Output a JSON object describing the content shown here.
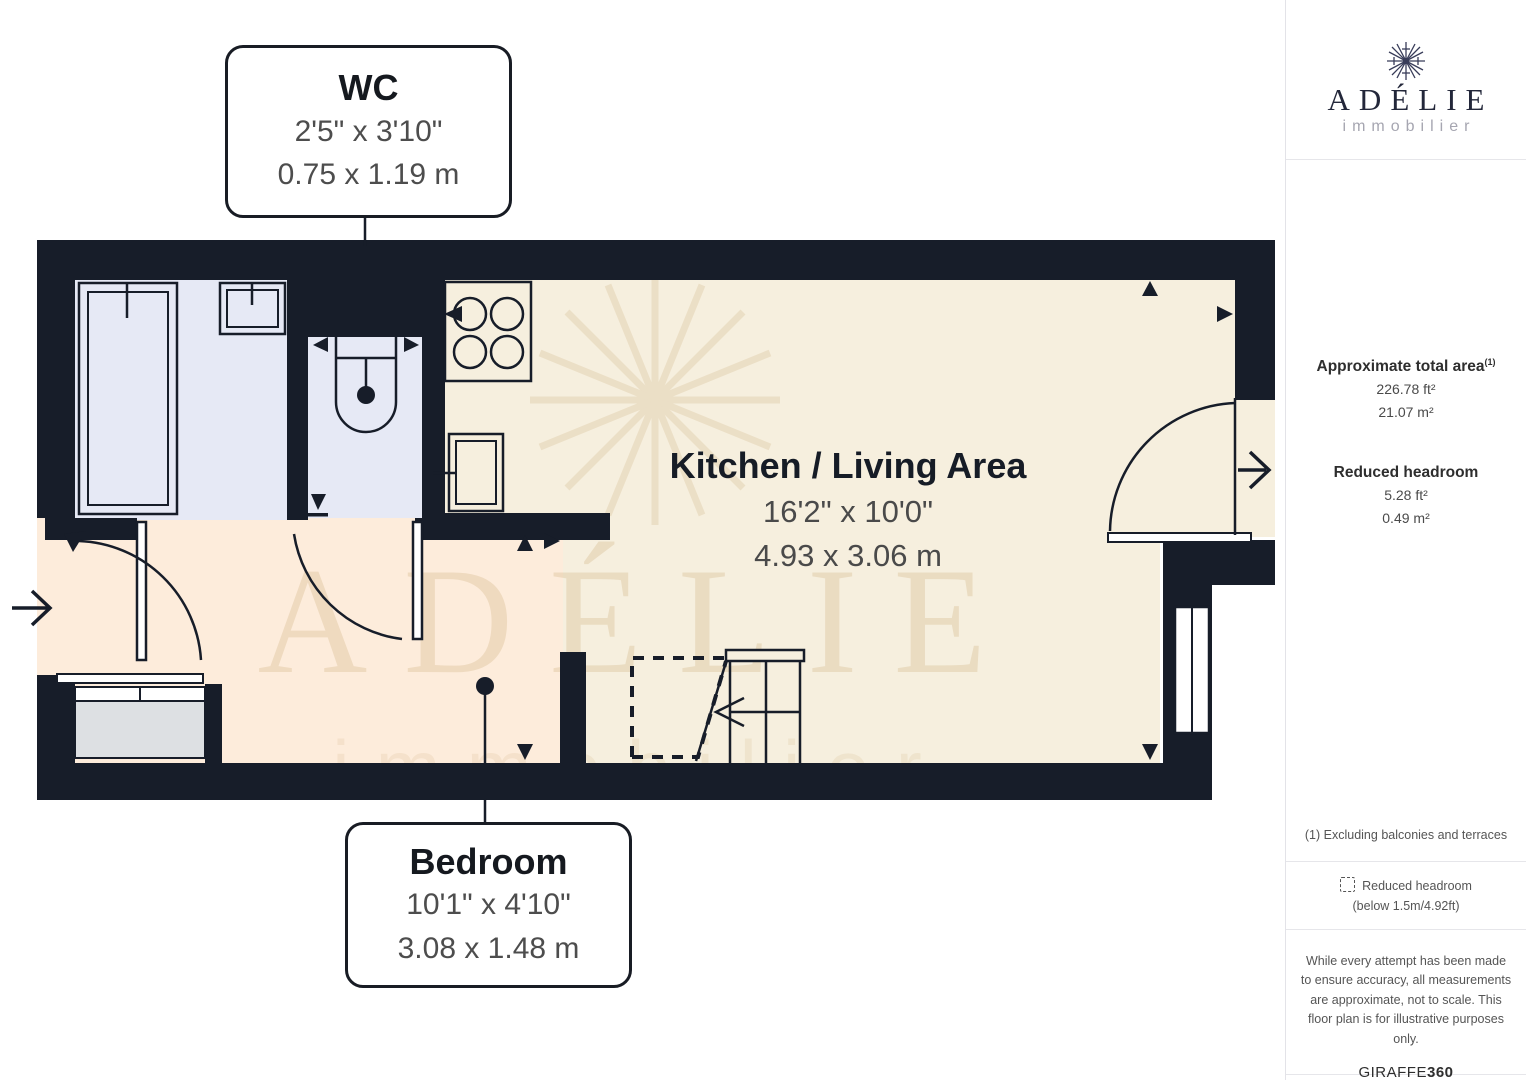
{
  "branding": {
    "name": "ADÉLIE",
    "tagline": "immobilier"
  },
  "sidebar": {
    "approx_area": {
      "label": "Approximate total area",
      "footnote_ref": "(1)",
      "imperial": "226.78 ft²",
      "metric": "21.07 m²"
    },
    "reduced_headroom": {
      "label": "Reduced headroom",
      "imperial": "5.28 ft²",
      "metric": "0.49 m²"
    },
    "footnote": "(1) Excluding balconies and terraces",
    "legend": {
      "label": "Reduced headroom",
      "detail": "(below 1.5m/4.92ft)"
    },
    "disclaimer": "While every attempt has been made to ensure accuracy, all measurements are approximate, not to scale. This floor plan is for illustrative purposes only.",
    "provider": {
      "brand": "GIRAFFE",
      "suffix": "360"
    }
  },
  "floorplan": {
    "rooms": [
      {
        "name": "WC",
        "imperial": "2'5\" x 3'10\"",
        "metric": "0.75 x 1.19 m"
      },
      {
        "name": "Kitchen / Living Area",
        "imperial": "16'2\" x 10'0\"",
        "metric": "4.93 x 3.06 m"
      },
      {
        "name": "Bedroom",
        "imperial": "10'1\" x 4'10\"",
        "metric": "3.08 x 1.48 m"
      }
    ],
    "watermark": {
      "title": "ADÉLIE",
      "subtitle": "immobilier"
    },
    "colors": {
      "wall": "#171d29",
      "wet_room_floor": "#e6e9f5",
      "kitchen_floor": "#f6efde",
      "bedroom_floor": "#fdecdb",
      "closet_fill": "#dde0e3",
      "watermark_tint": "#c9a873"
    }
  }
}
